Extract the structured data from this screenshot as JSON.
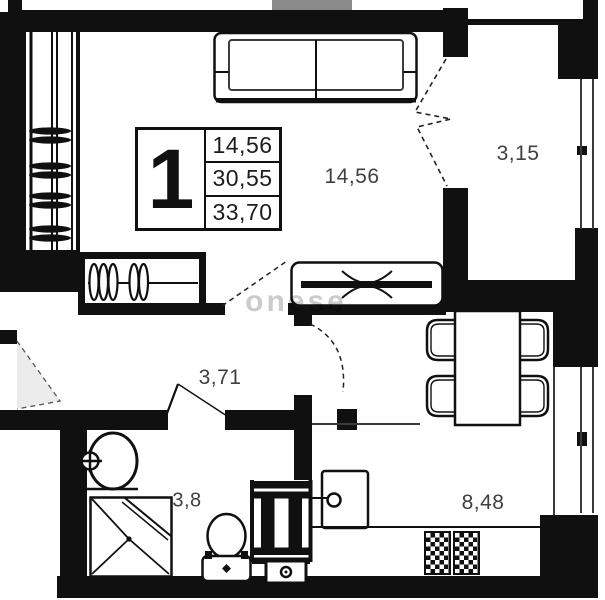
{
  "plan": {
    "info_box": {
      "rooms": "1",
      "line1": "14,56",
      "line2": "30,55",
      "line3": "33,70"
    },
    "labels": {
      "living_room": "14,56",
      "balcony": "3,15",
      "hallway": "3,71",
      "bathroom": "3,8",
      "kitchen": "8,48"
    },
    "watermark": "onese",
    "colors": {
      "wall": "#101010",
      "door_swing_fill": "#ececec",
      "label_text": "#404040"
    }
  }
}
